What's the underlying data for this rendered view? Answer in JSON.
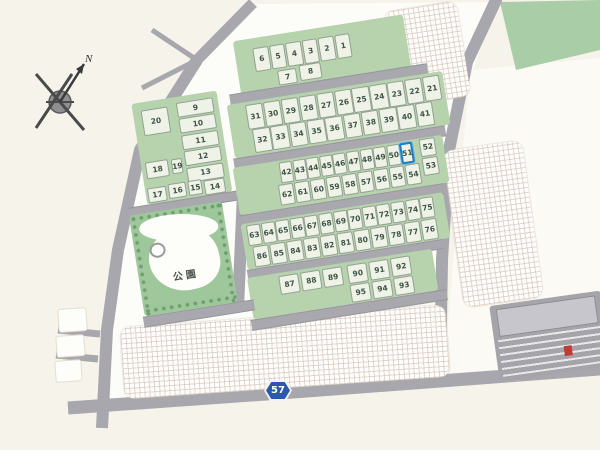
{
  "compass": {
    "label": "N"
  },
  "park": {
    "label": "公園"
  },
  "route_marker": {
    "number": "57"
  },
  "highlight": {
    "lot": "51",
    "color": "#1b7ec2"
  },
  "colors": {
    "background": "#f6f3ea",
    "block_green": "#b7d3ae",
    "park_green": "#9fc79c",
    "lot_fill": "#eef2e7",
    "road_gray": "#a8a8ae",
    "route_badge_blue": "#2b57ad",
    "highlight_blue": "#1b7ec2"
  },
  "lots": {
    "block_a_top": [
      "6",
      "5",
      "4",
      "3",
      "2",
      "1"
    ],
    "block_a_inner": [
      "7",
      "8"
    ],
    "left_single": [
      "20"
    ],
    "left_column": [
      "9",
      "10",
      "11",
      "12",
      "13"
    ],
    "left_pair": [
      "18",
      "19"
    ],
    "left_bottom": [
      "17",
      "16",
      "15",
      "14"
    ],
    "block_b_top": [
      "31",
      "30",
      "29",
      "28",
      "27",
      "26",
      "25",
      "24",
      "23",
      "22",
      "21"
    ],
    "block_b_bottom": [
      "32",
      "33",
      "34",
      "35",
      "36",
      "37",
      "38",
      "39",
      "40",
      "41"
    ],
    "block_c_top": [
      "42",
      "43",
      "44",
      "45",
      "46",
      "47",
      "48",
      "49",
      "50",
      "51"
    ],
    "block_c_right": [
      "52",
      "53"
    ],
    "block_c_bottom": [
      "62",
      "61",
      "60",
      "59",
      "58",
      "57",
      "56",
      "55",
      "54"
    ],
    "block_d_top": [
      "63",
      "64",
      "65",
      "66",
      "67",
      "68",
      "69",
      "70",
      "71",
      "72",
      "73",
      "74",
      "75"
    ],
    "block_d_bottom": [
      "86",
      "85",
      "84",
      "83",
      "82",
      "81",
      "80",
      "79",
      "78",
      "77",
      "76"
    ],
    "block_e_top": [
      "87",
      "88",
      "89",
      "90",
      "91",
      "92"
    ],
    "block_e_bottom": [
      "95",
      "94",
      "93"
    ]
  }
}
